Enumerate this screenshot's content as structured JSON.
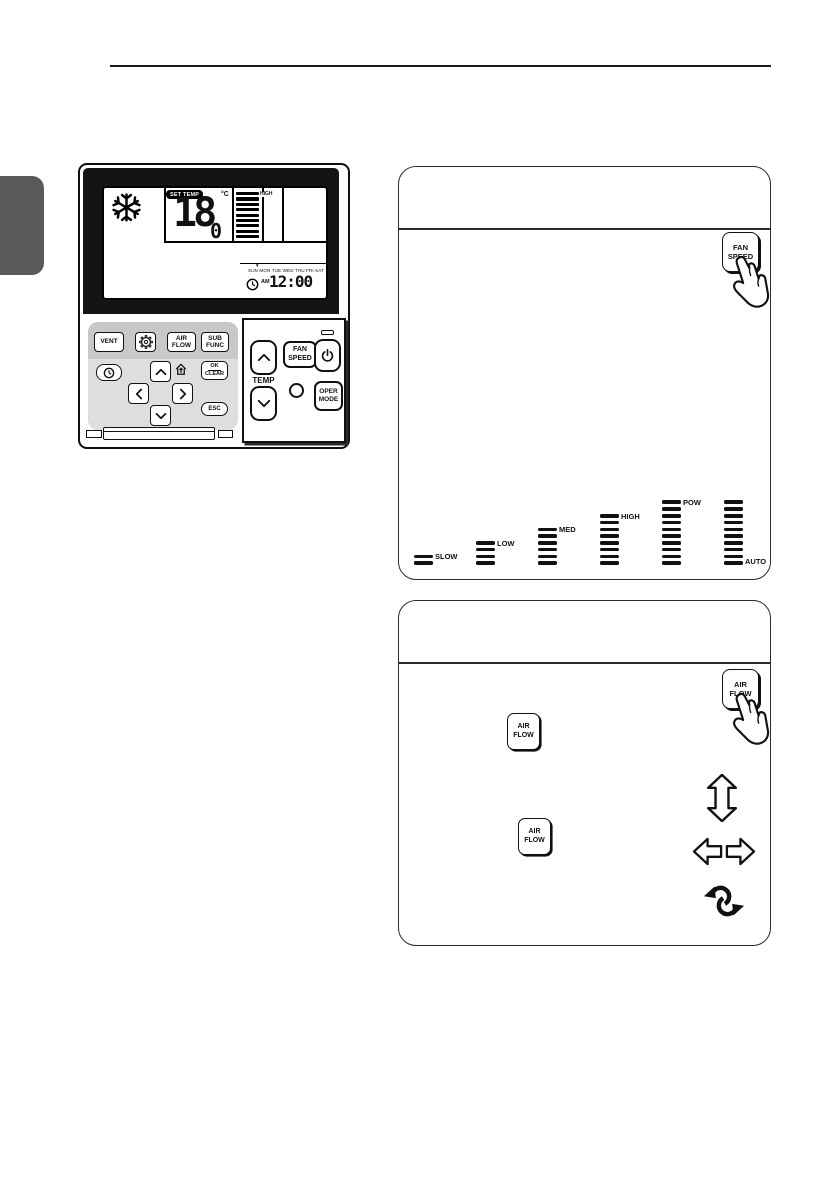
{
  "page": {
    "section_tab_color": "#58595b"
  },
  "remote": {
    "lcd": {
      "mode_icon": "snowflake-icon",
      "set_temp_badge": "SET TEMP",
      "temp_value": "18",
      "temp_decimal": "0",
      "temp_unit": "°C",
      "fan_bar_count": 9,
      "fan_level_label": "HIGH",
      "week_marker": "▼",
      "weekdays": "SUN MON TUE WED THU FRI SAT",
      "meridiem": "AM",
      "time": "12:00"
    },
    "left_panel": {
      "vent_label": "VENT",
      "settings_icon": "gear-icon",
      "air_flow_label": "AIR\nFLOW",
      "sub_func_label": "SUB\nFUNC",
      "timer_icon": "clock-icon",
      "ok_label": "OK",
      "clear_label": "CLEAR",
      "esc_label": "ESC",
      "nav_icons": [
        "chevron-up-icon",
        "chevron-left-icon",
        "chevron-right-icon",
        "chevron-down-icon",
        "home-icon"
      ]
    },
    "right_panel": {
      "temp_label": "TEMP",
      "fan_speed_label": "FAN\nSPEED",
      "oper_mode_label": "OPER\nMODE",
      "power_icon": "power-icon"
    }
  },
  "fan_speed_section": {
    "button_label": "FAN\nSPEED",
    "levels": [
      {
        "label": "SLOW",
        "bars": 2,
        "label_position": "top"
      },
      {
        "label": "LOW",
        "bars": 4,
        "label_position": "top"
      },
      {
        "label": "MED",
        "bars": 6,
        "label_position": "top"
      },
      {
        "label": "HIGH",
        "bars": 8,
        "label_position": "top"
      },
      {
        "label": "POW",
        "bars": 10,
        "label_position": "top"
      },
      {
        "label": "AUTO",
        "bars": 10,
        "label_position": "bottom"
      }
    ]
  },
  "air_flow_section": {
    "pressed_button_label": "AIR\nFLOW",
    "step_button_labels": [
      "AIR\nFLOW",
      "AIR\nFLOW"
    ],
    "direction_icons": [
      "vertical-swing-icon",
      "horizontal-swing-icon",
      "swirl-swing-icon"
    ]
  }
}
